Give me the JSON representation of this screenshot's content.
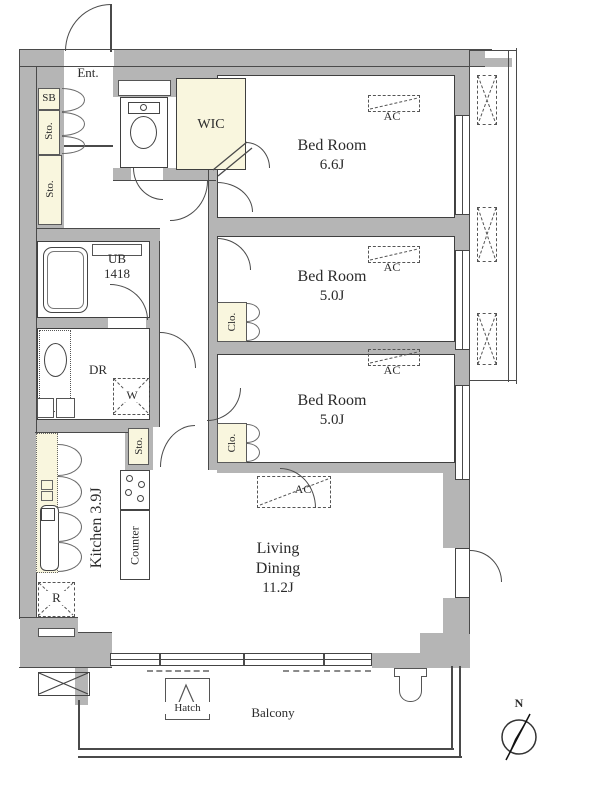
{
  "plan": {
    "entrance": {
      "label": "Ent."
    },
    "shoe_box": {
      "label": "SB"
    },
    "storage": {
      "label": "Sto."
    },
    "wic": {
      "label": "WIC"
    },
    "unit_bath": {
      "label": "UB",
      "size": "1418"
    },
    "dressing_room": {
      "label": "DR"
    },
    "washer": {
      "label": "W"
    },
    "closet": {
      "label": "Clo."
    },
    "hall_storage": {
      "label": "Sto."
    },
    "kitchen": {
      "label": "Kitchen 3.9J",
      "counter": "Counter",
      "fridge": "R"
    },
    "bedroom1": {
      "name": "Bed Room",
      "size": "6.6J",
      "ac": "AC"
    },
    "bedroom2": {
      "name": "Bed Room",
      "size": "5.0J",
      "ac": "AC"
    },
    "bedroom3": {
      "name": "Bed Room",
      "size": "5.0J",
      "ac": "AC"
    },
    "living_dining": {
      "name1": "Living",
      "name2": "Dining",
      "size": "11.2J",
      "ac": "AC"
    },
    "balcony": {
      "label": "Balcony",
      "hatch": "Hatch"
    },
    "compass": {
      "north": "N"
    }
  },
  "colors": {
    "wall": "#b5b5b5",
    "accent": "#f9f6de",
    "outline": "#3f3f3f"
  }
}
